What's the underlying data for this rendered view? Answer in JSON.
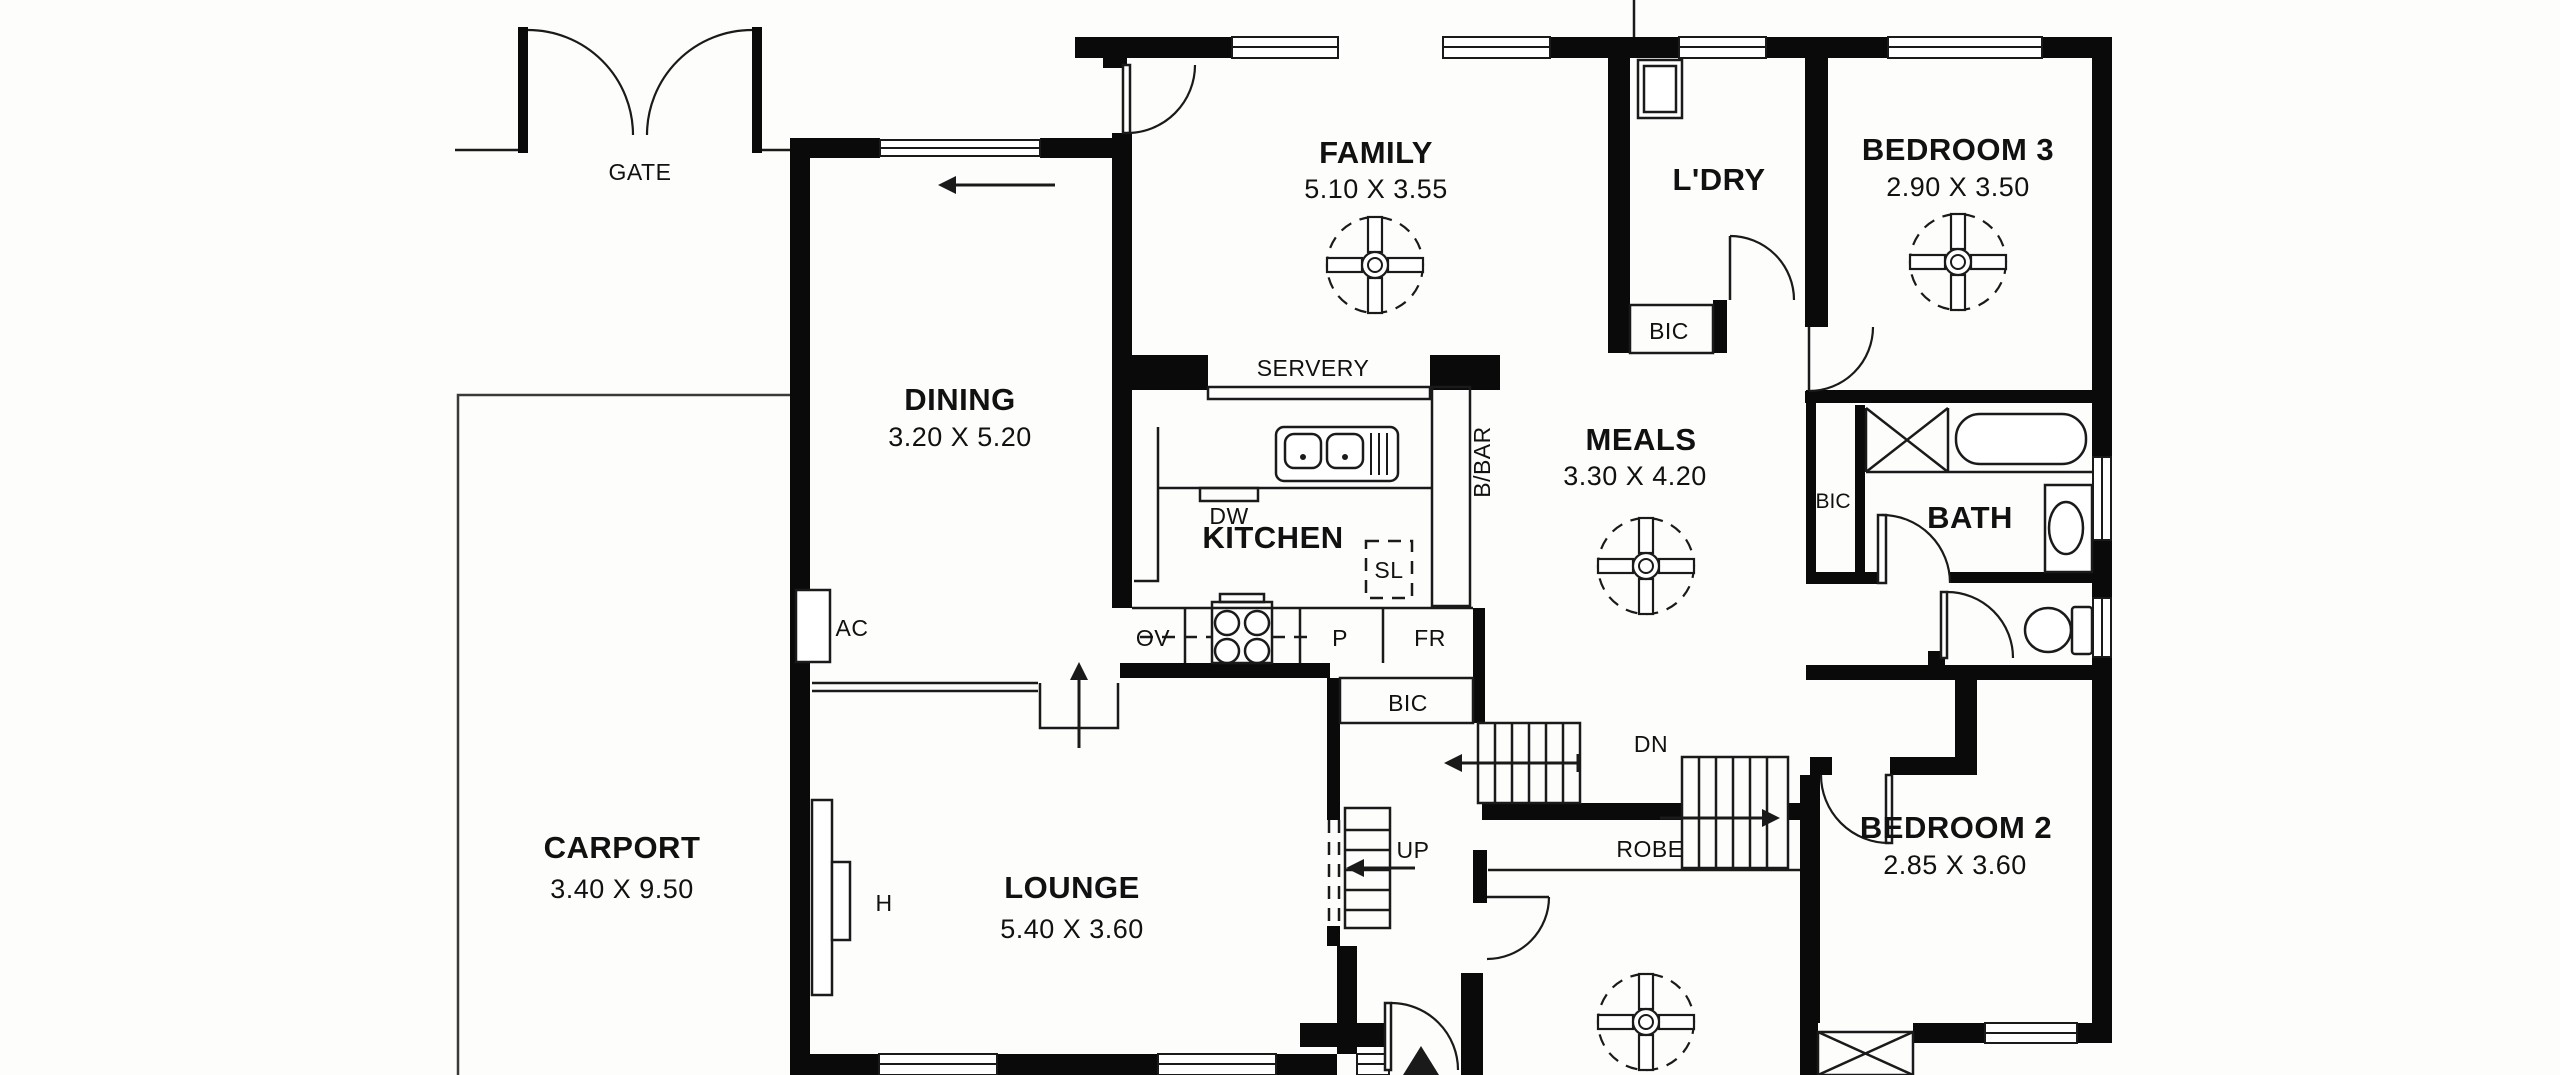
{
  "document": {
    "type": "residential-floor-plan",
    "colors": {
      "wall": "#0a0a0a",
      "paper": "#fdfdfc",
      "line": "#1a1a1a"
    }
  },
  "rooms": {
    "family": {
      "name": "FAMILY",
      "dims": "5.10 X 3.55"
    },
    "dining": {
      "name": "DINING",
      "dims": "3.20 X 5.20"
    },
    "meals": {
      "name": "MEALS",
      "dims": "3.30 X 4.20"
    },
    "kitchen": {
      "name": "KITCHEN"
    },
    "laundry": {
      "name": "L'DRY"
    },
    "bath": {
      "name": "BATH"
    },
    "bedroom3": {
      "name": "BEDROOM 3",
      "dims": "2.90 X 3.50"
    },
    "bedroom2": {
      "name": "BEDROOM 2",
      "dims": "2.85 X 3.60"
    },
    "lounge": {
      "name": "LOUNGE",
      "dims": "5.40 X 3.60"
    },
    "carport": {
      "name": "CARPORT",
      "dims": "3.40 X 9.50"
    }
  },
  "labels": {
    "gate": "GATE",
    "servery": "SERVERY",
    "bbar": "B/BAR",
    "robe": "ROBE",
    "up": "UP",
    "dn": "DN",
    "ac": "AC",
    "heater": "H",
    "dishwasher": "DW",
    "sl": "SL",
    "oven": "OV",
    "pantry": "P",
    "fridge": "FR",
    "bic": "BIC"
  }
}
